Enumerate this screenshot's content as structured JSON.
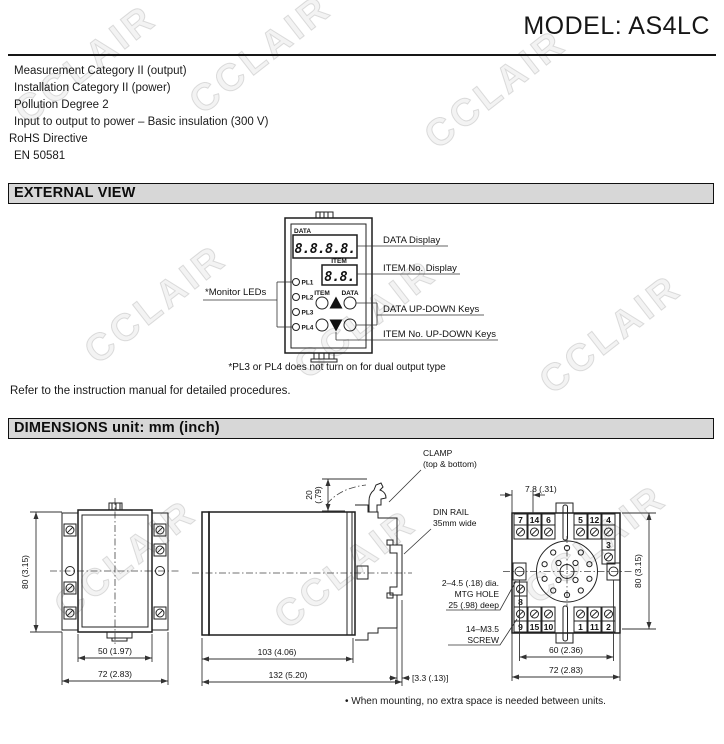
{
  "page": {
    "title": "MODEL: AS4LC",
    "watermark": "CCLAIR",
    "specs": [
      "Measurement Category II (output)",
      "Installation Category II (power)",
      "Pollution Degree 2",
      "Input to output to power – Basic insulation (300 V)",
      "RoHS Directive",
      "EN 50581"
    ],
    "refer_note": "Refer to the instruction manual for detailed procedures.",
    "mounting_note": "• When mounting, no extra space is needed between units."
  },
  "sections": {
    "external_view": "EXTERNAL VIEW",
    "dimensions": "DIMENSIONS unit: mm (inch)"
  },
  "device": {
    "data_label": "DATA",
    "item_label": "ITEM",
    "data_display": "8.8.8.8.",
    "item_display": "8.8.",
    "leds": [
      "PL1",
      "PL2",
      "PL3",
      "PL4"
    ],
    "key_item_label": "ITEM",
    "key_data_label": "DATA",
    "monitor_leds": "*Monitor LEDs",
    "callout_data_display": "DATA Display",
    "callout_item_display": "ITEM No. Display",
    "callout_data_keys": "DATA UP-DOWN Keys",
    "callout_item_keys": "ITEM No. UP-DOWN Keys",
    "footnote": "*PL3 or PL4 does not turn on for dual output type"
  },
  "dims": {
    "front": {
      "h": "80 (3.15)",
      "w_inner": "50 (1.97)",
      "w_outer": "72 (2.83)"
    },
    "side": {
      "clamp_mm": "20",
      "clamp_in": "(.79)",
      "depth_body": "103 (4.06)",
      "depth_total": "132 (5.20)",
      "rail_gap": "[3.3 (.13)]",
      "clamp_label_1": "CLAMP",
      "clamp_label_2": "(top & bottom)",
      "din_label_1": "DIN RAIL",
      "din_label_2": "35mm wide"
    },
    "socket": {
      "pitch": "7.8 (.31)",
      "h": "80 (3.15)",
      "w_holes": "60 (2.36)",
      "w_outer": "72 (2.83)",
      "mtg_1": "2–4.5 (.18) dia.",
      "mtg_2": "MTG HOLE",
      "mtg_3": "25 (.98) deep",
      "screw_1": "14–M3.5",
      "screw_2": "SCREW",
      "t_top": [
        "7",
        "14",
        "6",
        "5",
        "12",
        "4"
      ],
      "t_right": "3",
      "t_left": "8",
      "t_bottom": [
        "9",
        "15",
        "10",
        "1",
        "11",
        "2"
      ]
    }
  }
}
